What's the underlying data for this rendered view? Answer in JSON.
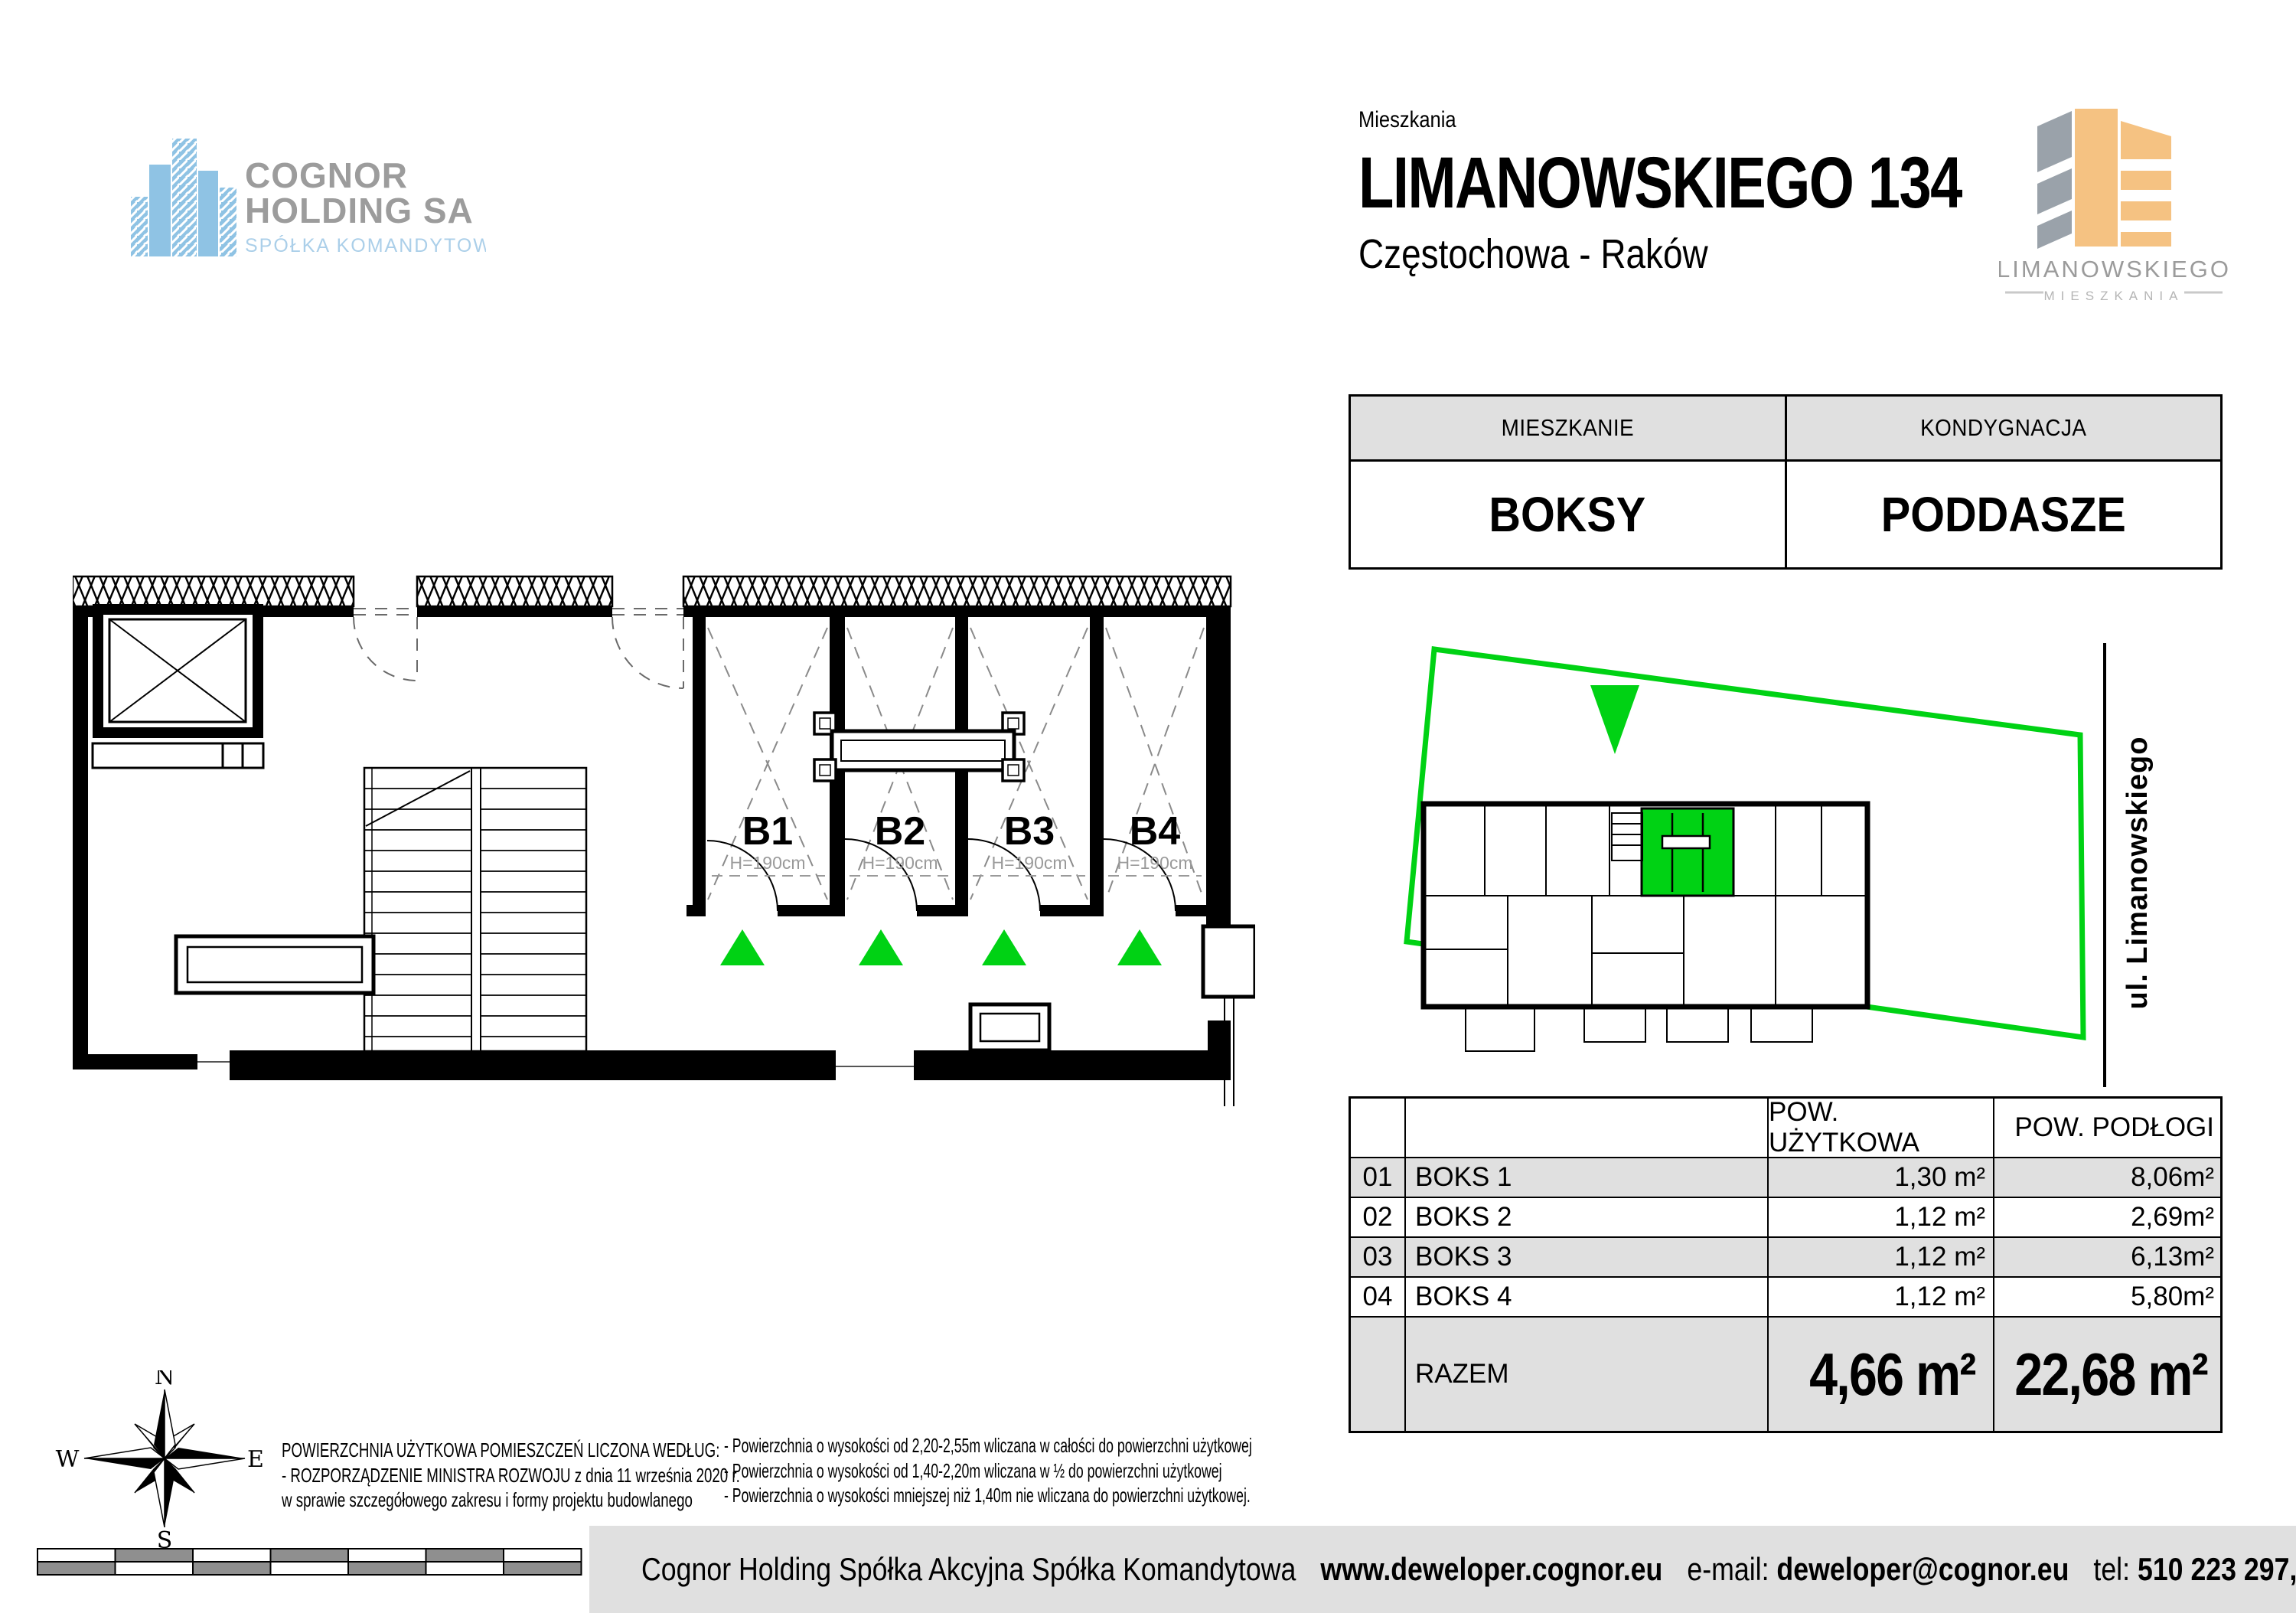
{
  "header": {
    "eyebrow": "Mieszkania",
    "title": "LIMANOWSKIEGO 134",
    "subtitle": "Częstochowa - Raków"
  },
  "branding": {
    "developer_logo": {
      "line1": "COGNOR",
      "line2": "HOLDING SA",
      "line3": "SPÓŁKA KOMANDYTOWA"
    },
    "project_logo": {
      "name": "LIMANOWSKIEGO",
      "subtitle": "MIESZKANIA"
    }
  },
  "info_table": {
    "col1_header": "MIESZKANIE",
    "col2_header": "KONDYGNACJA",
    "col1_value": "BOKSY",
    "col2_value": "PODDASZE"
  },
  "floor_plan": {
    "boxes": [
      {
        "label": "B1",
        "height_note": "H=190cm"
      },
      {
        "label": "B2",
        "height_note": "H=190cm"
      },
      {
        "label": "B3",
        "height_note": "H=190cm"
      },
      {
        "label": "B4",
        "height_note": "H=190cm"
      }
    ]
  },
  "mini_plan": {
    "street_label": "ul. Limanowskiego"
  },
  "areas_table": {
    "headers": {
      "usable": "POW. UŻYTKOWA",
      "floor": "POW. PODŁOGI"
    },
    "rows": [
      {
        "no": "01",
        "name": "BOKS 1",
        "usable": "1,30 m²",
        "floor": "8,06m²"
      },
      {
        "no": "02",
        "name": "BOKS 2",
        "usable": "1,12 m²",
        "floor": "2,69m²"
      },
      {
        "no": "03",
        "name": "BOKS 3",
        "usable": "1,12 m²",
        "floor": "6,13m²"
      },
      {
        "no": "04",
        "name": "BOKS 4",
        "usable": "1,12 m²",
        "floor": "5,80m²"
      }
    ],
    "total": {
      "label": "RAZEM",
      "usable": "4,66 m²",
      "floor": "22,68 m²"
    }
  },
  "compass": {
    "n": "N",
    "e": "E",
    "s": "S",
    "w": "W"
  },
  "legal": {
    "left": [
      "POWIERZCHNIA UŻYTKOWA POMIESZCZEŃ LICZONA WEDŁUG:",
      "- ROZPORZĄDZENIE MINISTRA ROZWOJU z dnia 11 września 2020 r.",
      "w sprawie szczegółowego zakresu i formy projektu budowlanego"
    ],
    "right": [
      "- Powierzchnia o wysokości od 2,20-2,55m wliczana w całości do powierzchni użytkowej",
      "- Powierzchnia o wysokości od 1,40-2,20m wliczana w ½ do powierzchni użytkowej",
      "- Powierzchnia o wysokości mniejszej niż 1,40m nie wliczana do powierzchni użytkowej."
    ]
  },
  "footer": {
    "company": "Cognor Holding Spółka Akcyjna Spółka Komandytowa",
    "website": "www.deweloper.cognor.eu",
    "email_label": "e-mail:",
    "email": "deweloper@cognor.eu",
    "phone_label": "tel:",
    "phones": "510 223 297, 510 223 631"
  },
  "colors": {
    "accent_green": "#00D214",
    "table_gray": "#e0e0e0",
    "scalebar_gray": "#8f8f8f",
    "logo_blue": "#8fc3e4",
    "logo_text_gray": "#9c9c9c",
    "logo_orange": "#f5c282",
    "plan_annotation_gray": "#9a9a9a"
  }
}
